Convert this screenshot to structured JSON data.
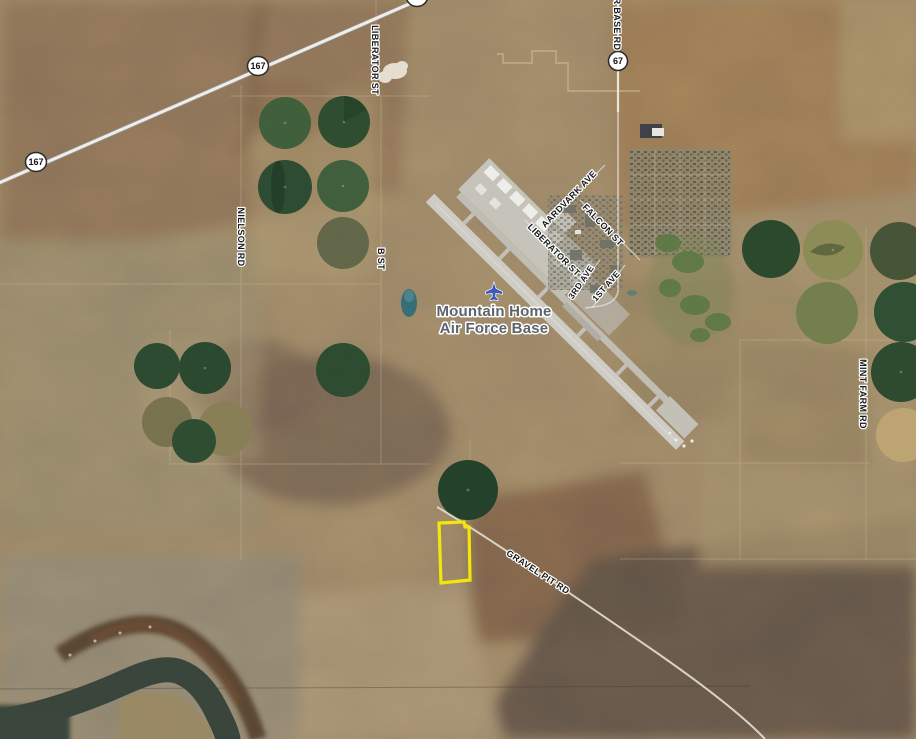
{
  "map": {
    "place_label": {
      "line1": "Mountain Home",
      "line2": "Air Force Base",
      "icon": "airplane-icon",
      "text_color": "#5d646b",
      "icon_color": "#3c59c0"
    },
    "highway_shields": [
      {
        "route": "167"
      },
      {
        "route": "167"
      },
      {
        "route": "67"
      }
    ],
    "road_labels": [
      {
        "name": "LIBERATOR ST"
      },
      {
        "name": "R BASE RD"
      },
      {
        "name": "NIELSON RD"
      },
      {
        "name": "B ST"
      },
      {
        "name": "AARDVARK AVE"
      },
      {
        "name": "FALCON ST"
      },
      {
        "name": "LIBERATOR ST"
      },
      {
        "name": "3RD AVE"
      },
      {
        "name": "1ST AVE"
      },
      {
        "name": "GRAVEL PIT RD"
      },
      {
        "name": "MINT FARM RD"
      }
    ],
    "parcel_highlight": {
      "outline_color": "#f2e60a"
    }
  }
}
